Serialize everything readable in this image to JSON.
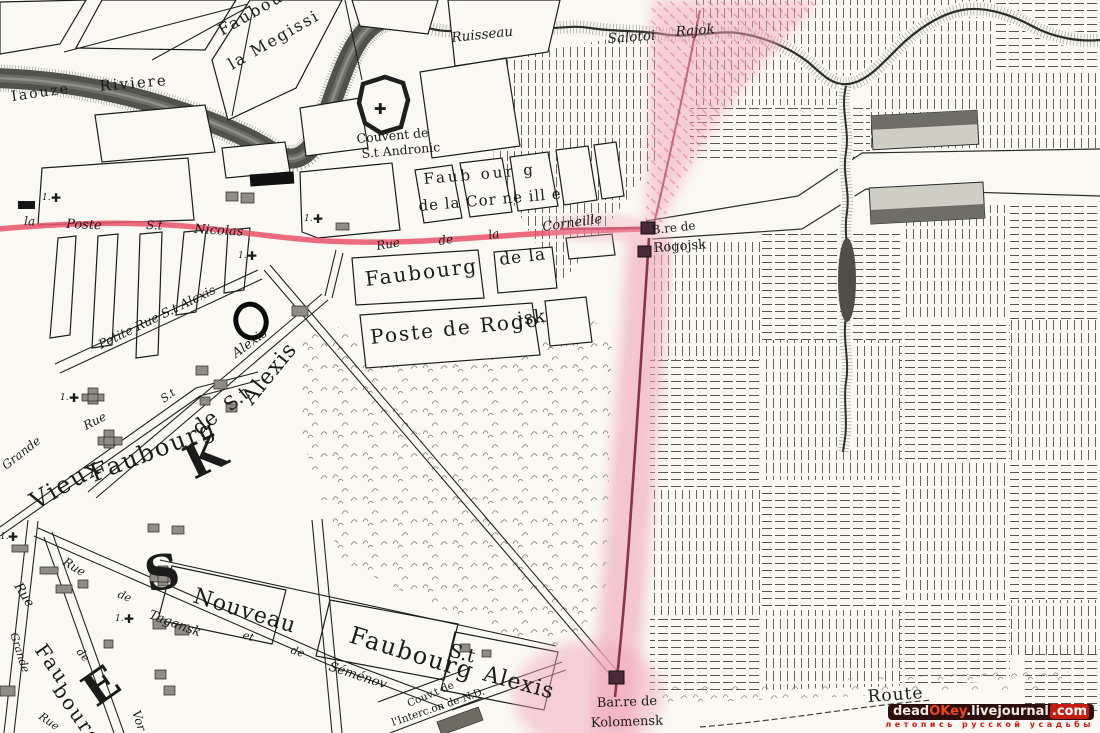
{
  "map": {
    "labels": {
      "megisserie1": "Faubou",
      "megisserie2": "la Megissi",
      "iaouze": "Iaouze",
      "riviere": "Riviere",
      "ruisseau": "Ruisseau",
      "salotoi": "Salotoi",
      "rajok": "Rajok",
      "couvent1": "Couvent de",
      "couvent2": "S.t Andronic",
      "corneille1": "Faub our g",
      "corneille2": "de la Cor ne ill e",
      "rueCorn1": "Rue",
      "rueCorn2": "de",
      "rueCorn3": "la",
      "rueCorn4": "Corneille",
      "poste1": "la",
      "poste2": "Poste",
      "poste3": "S.t",
      "poste4": "Nicolas",
      "faubourg": "Faubourg",
      "dela": "de la",
      "posteRogo": "Poste de Rogo",
      "jsk": "jsk",
      "bre1": "B.re de",
      "bre2": "Rogojsk",
      "petiteRue": "Petite Rue S.t Alexis",
      "stStreet": "S.t",
      "alexisStreet": "Alexis",
      "vieux": "Vieux",
      "vieuxFaubourg": "Faubourg",
      "vieuxDe": "de",
      "vieuxSt": "S.t",
      "vieuxAlexis": "Alexis",
      "grandeRue1": "Grande",
      "grandeRue2": "Rue",
      "nouveau": "Nouveau",
      "nouvFaubourg": "Faubourg",
      "nouvSt": "S.t",
      "nouvAlexis": "Alexis",
      "tagRue": "Rue",
      "tagRue2": "Rue",
      "tagDe": "de",
      "tagansk": "Tagansk",
      "tagEt": "et",
      "tagDe2": "de",
      "semenov": "Séménov",
      "grandeB": "Grande",
      "rueB": "Rue",
      "fau": "Fau",
      "bourg": "bourg",
      "deB": "de",
      "vor": "Vor",
      "couvNd1": "Couv.t de",
      "couvNd2": "l'Interc.on de N.D.",
      "barre1": "Bar.re de",
      "barre2": "Kolomensk",
      "route": "Route",
      "crossNum": "1.",
      "cross": "✚",
      "bigK": "K",
      "bigS": "S",
      "bigE": "E"
    }
  },
  "watermark": {
    "dead": "dead",
    "okey": "OKey",
    "livejournal": ".livejournal",
    "com": ".com",
    "tagline": "летопись русской усадьбы"
  },
  "colors": {
    "road_red": "#e8566c",
    "boundary_pink": "#f2a8bc",
    "rampart_red": "#8a3545",
    "ink": "#1b1b1b",
    "watermark_bg": "#2e0d0d",
    "watermark_red": "#c41e14"
  }
}
